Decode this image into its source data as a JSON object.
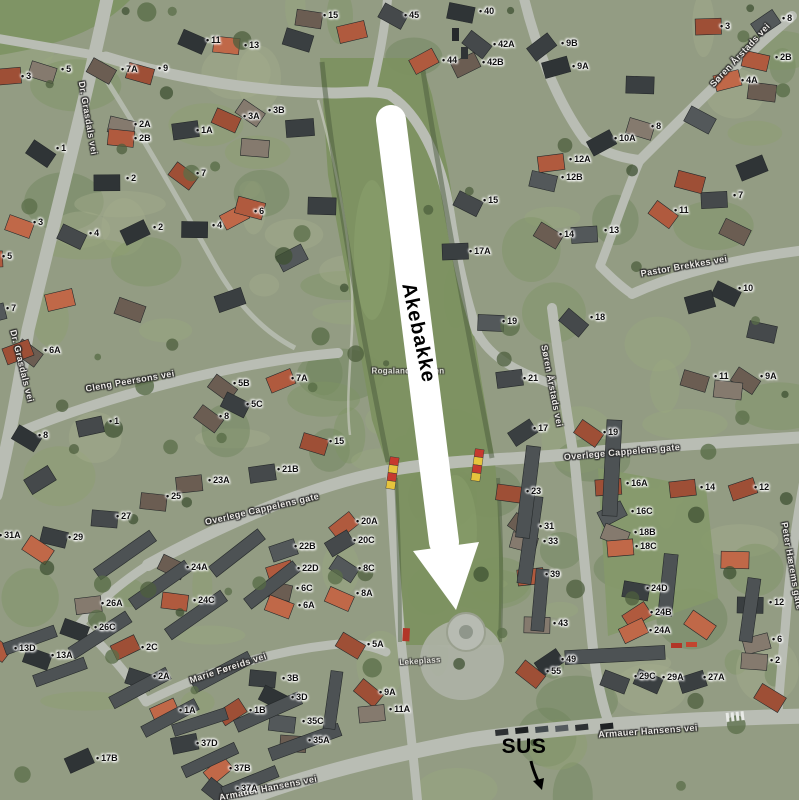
{
  "annotations": {
    "akebakke": {
      "text": "Akebakke",
      "x": 418,
      "y": 333,
      "rotation": 78,
      "color": "#000000"
    },
    "sus": {
      "text": "SUS",
      "x": 524,
      "y": 747,
      "color": "#000000",
      "arrow": {
        "from": [
          531,
          761
        ],
        "to": [
          541,
          788
        ]
      }
    },
    "route_arrow": {
      "color": "#ffffff",
      "from": [
        391,
        120
      ],
      "to": [
        444,
        542
      ],
      "head": [
        [
          413,
          551
        ],
        [
          479,
          542
        ],
        [
          456,
          610
        ]
      ]
    }
  },
  "street_labels": [
    {
      "text": "Dr. Grasdals vei",
      "x": 88,
      "y": 118,
      "rot": 80
    },
    {
      "text": "Dr. Grasdals vei",
      "x": 22,
      "y": 366,
      "rot": 76
    },
    {
      "text": "Cleng Peersons vei",
      "x": 130,
      "y": 381,
      "rot": -10
    },
    {
      "text": "Overlege Cappelens gate",
      "x": 262,
      "y": 509,
      "rot": -13
    },
    {
      "text": "Overlege Cappelens gate",
      "x": 622,
      "y": 452,
      "rot": -5
    },
    {
      "text": "Pastor Brekkes vei",
      "x": 684,
      "y": 266,
      "rot": -10
    },
    {
      "text": "Søren Årstads vei",
      "x": 740,
      "y": 55,
      "rot": -47
    },
    {
      "text": "Søren Årstads vei",
      "x": 552,
      "y": 386,
      "rot": 79
    },
    {
      "text": "Marie Føreids vei",
      "x": 228,
      "y": 668,
      "rot": -18
    },
    {
      "text": "Armauer Hansens vei",
      "x": 648,
      "y": 731,
      "rot": -4
    },
    {
      "text": "Armauer Hansens vei",
      "x": 268,
      "y": 788,
      "rot": -11
    },
    {
      "text": "Peter Hærems gate",
      "x": 792,
      "y": 566,
      "rot": 80
    }
  ],
  "area_labels": [
    {
      "text": "Rogalandsbakken",
      "x": 408,
      "y": 371,
      "rot": 0
    },
    {
      "text": "Lekeplass",
      "x": 420,
      "y": 661,
      "rot": -4
    }
  ],
  "house_numbers": [
    [
      25,
      78,
      "3"
    ],
    [
      65,
      71,
      "5"
    ],
    [
      125,
      71,
      "7A"
    ],
    [
      162,
      70,
      "9"
    ],
    [
      210,
      42,
      "11"
    ],
    [
      248,
      47,
      "13"
    ],
    [
      138,
      126,
      "2A"
    ],
    [
      138,
      140,
      "2B"
    ],
    [
      200,
      132,
      "1A"
    ],
    [
      247,
      118,
      "3A"
    ],
    [
      272,
      112,
      "3B"
    ],
    [
      60,
      150,
      "1"
    ],
    [
      130,
      180,
      "2"
    ],
    [
      200,
      175,
      "7"
    ],
    [
      37,
      224,
      "3"
    ],
    [
      93,
      235,
      "4"
    ],
    [
      157,
      229,
      "2"
    ],
    [
      216,
      227,
      "4"
    ],
    [
      258,
      213,
      "6"
    ],
    [
      6,
      258,
      "5"
    ],
    [
      327,
      17,
      "15"
    ],
    [
      408,
      17,
      "45"
    ],
    [
      483,
      13,
      "40"
    ],
    [
      446,
      62,
      "44"
    ],
    [
      497,
      46,
      "42A"
    ],
    [
      486,
      64,
      "42B"
    ],
    [
      565,
      45,
      "9B"
    ],
    [
      576,
      68,
      "9A"
    ],
    [
      724,
      28,
      "3"
    ],
    [
      779,
      59,
      "2B"
    ],
    [
      745,
      82,
      "4A"
    ],
    [
      786,
      20,
      "8"
    ],
    [
      655,
      128,
      "8"
    ],
    [
      678,
      212,
      "11"
    ],
    [
      737,
      197,
      "7"
    ],
    [
      618,
      140,
      "10A"
    ],
    [
      573,
      161,
      "12A"
    ],
    [
      565,
      179,
      "12B"
    ],
    [
      742,
      290,
      "10"
    ],
    [
      487,
      202,
      "15"
    ],
    [
      563,
      236,
      "14"
    ],
    [
      608,
      232,
      "13"
    ],
    [
      473,
      253,
      "17A"
    ],
    [
      506,
      323,
      "19"
    ],
    [
      594,
      319,
      "18"
    ],
    [
      718,
      378,
      "11"
    ],
    [
      764,
      378,
      "9A"
    ],
    [
      527,
      380,
      "21"
    ],
    [
      537,
      430,
      "17"
    ],
    [
      607,
      434,
      "19"
    ],
    [
      10,
      310,
      "7"
    ],
    [
      48,
      352,
      "6A"
    ],
    [
      237,
      385,
      "5B"
    ],
    [
      295,
      380,
      "7A"
    ],
    [
      250,
      406,
      "5C"
    ],
    [
      42,
      437,
      "8"
    ],
    [
      113,
      423,
      "1"
    ],
    [
      223,
      418,
      "8"
    ],
    [
      333,
      443,
      "15"
    ],
    [
      72,
      539,
      "29"
    ],
    [
      120,
      518,
      "27"
    ],
    [
      170,
      498,
      "25"
    ],
    [
      212,
      482,
      "23A"
    ],
    [
      281,
      471,
      "21B"
    ],
    [
      3,
      537,
      "31A"
    ],
    [
      360,
      523,
      "20A"
    ],
    [
      357,
      542,
      "20C"
    ],
    [
      298,
      548,
      "22B"
    ],
    [
      301,
      570,
      "22D"
    ],
    [
      362,
      570,
      "8C"
    ],
    [
      300,
      590,
      "6C"
    ],
    [
      302,
      607,
      "6A"
    ],
    [
      360,
      595,
      "8A"
    ],
    [
      190,
      569,
      "24A"
    ],
    [
      197,
      602,
      "24C"
    ],
    [
      105,
      605,
      "26A"
    ],
    [
      98,
      629,
      "26C"
    ],
    [
      145,
      649,
      "2C"
    ],
    [
      157,
      678,
      "2A"
    ],
    [
      18,
      650,
      "13D"
    ],
    [
      55,
      657,
      "13A"
    ],
    [
      100,
      760,
      "17B"
    ],
    [
      183,
      712,
      "1A"
    ],
    [
      253,
      712,
      "1B"
    ],
    [
      286,
      680,
      "3B"
    ],
    [
      295,
      699,
      "3D"
    ],
    [
      306,
      723,
      "35C"
    ],
    [
      312,
      742,
      "35A"
    ],
    [
      200,
      745,
      "37D"
    ],
    [
      233,
      770,
      "37B"
    ],
    [
      240,
      790,
      "37A"
    ],
    [
      371,
      646,
      "5A"
    ],
    [
      383,
      694,
      "9A"
    ],
    [
      393,
      711,
      "11A"
    ],
    [
      530,
      493,
      "23"
    ],
    [
      543,
      528,
      "31"
    ],
    [
      547,
      543,
      "33"
    ],
    [
      549,
      576,
      "39"
    ],
    [
      557,
      625,
      "43"
    ],
    [
      565,
      661,
      "49"
    ],
    [
      550,
      673,
      "55"
    ],
    [
      630,
      485,
      "16A"
    ],
    [
      635,
      513,
      "16C"
    ],
    [
      638,
      534,
      "18B"
    ],
    [
      639,
      548,
      "18C"
    ],
    [
      650,
      590,
      "24D"
    ],
    [
      654,
      614,
      "24B"
    ],
    [
      653,
      632,
      "24A"
    ],
    [
      704,
      489,
      "14"
    ],
    [
      758,
      489,
      "12"
    ],
    [
      773,
      604,
      "12"
    ],
    [
      776,
      641,
      "6"
    ],
    [
      774,
      662,
      "2"
    ],
    [
      638,
      678,
      "29C"
    ],
    [
      666,
      679,
      "29A"
    ],
    [
      707,
      679,
      "27A"
    ]
  ],
  "barriers": {
    "positions": [
      [
        392,
        473
      ],
      [
        477,
        465
      ]
    ],
    "red": "#c63a2e",
    "yellow": "#e6c43c"
  },
  "colors": {
    "grass": "#7c9160",
    "road": "#b9bdb4",
    "roof_dark": "#45494b",
    "roof_red": "#b05a3e",
    "arrow_white": "#ffffff",
    "label_text": "#eceae6",
    "number_text": "#0e0e0e"
  }
}
